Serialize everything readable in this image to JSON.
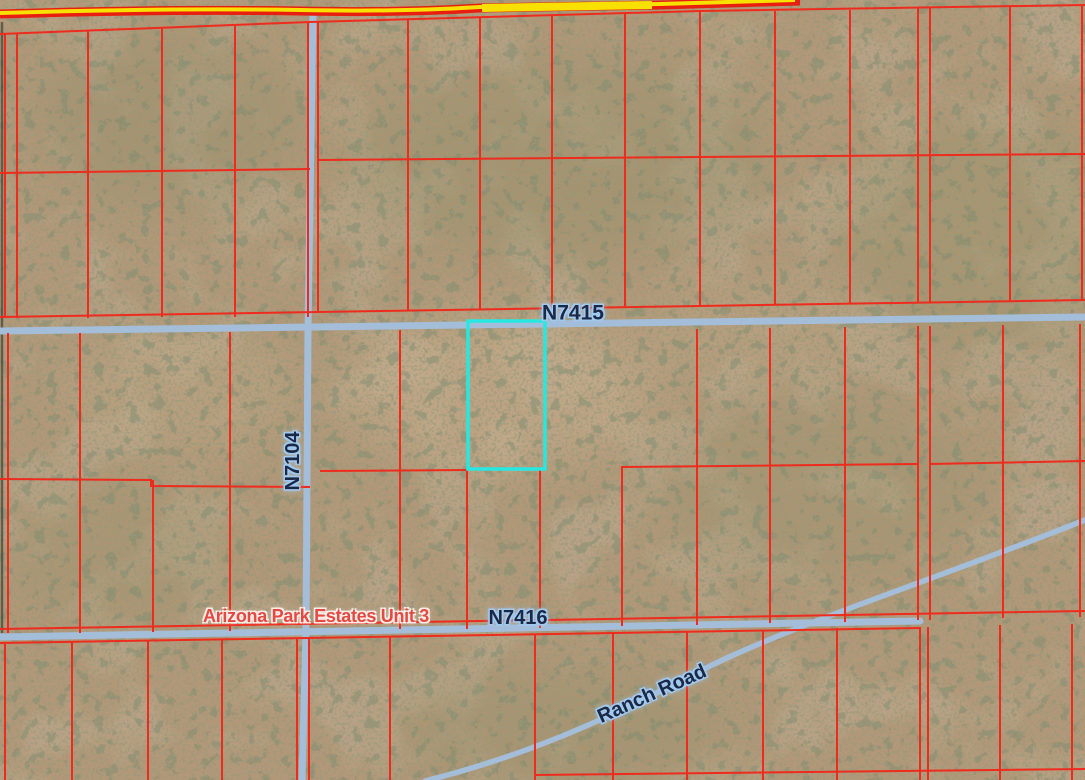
{
  "map": {
    "labels": {
      "road_n7415": "N7415",
      "road_n7104": "N7104",
      "road_n7416": "N7416",
      "ranch_road": "Ranch Road",
      "subdivision": "Arizona Park Estates Unit 3"
    },
    "colors": {
      "terrain_base": "#b29878",
      "parcel_line": "#ee2b1d",
      "road_fill": "#a4bdd9",
      "road_label_text": "#1b2944",
      "road_label_halo": "#a2c9f0",
      "subdivision_text": "#e34a42",
      "subdivision_halo": "#ffece8",
      "selected_parcel": "#26e8e0",
      "highway_red": "#e81f10",
      "highway_yellow": "#f8e000",
      "vegetation_fine": "#4c5433",
      "vegetation_coarse": "#33402a",
      "ground_wash": "#8d7355",
      "photo_edge": "#3b3b33"
    }
  }
}
